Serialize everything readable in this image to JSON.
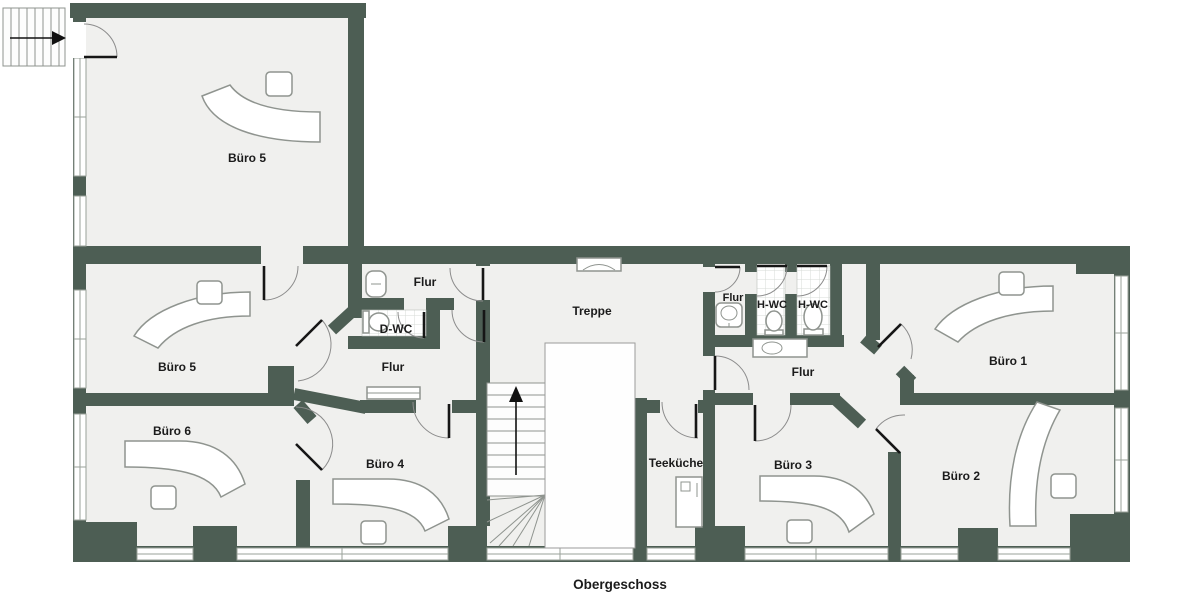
{
  "colors": {
    "bg": "#ffffff",
    "wall": "#4d5e54",
    "floor": "#f0f0ee",
    "void": "#fefefe",
    "label": "#1b1b1b",
    "furniture": "#8f948f",
    "door": "#161616",
    "window": "#9aa29a",
    "tile": "#d7dbd7"
  },
  "floor_label": "Obergeschoss",
  "rooms": [
    {
      "id": "buero5-upper",
      "label": "Büro 5"
    },
    {
      "id": "buero5-mid",
      "label": "Büro 5"
    },
    {
      "id": "buero6",
      "label": "Büro 6"
    },
    {
      "id": "buero4",
      "label": "Büro 4"
    },
    {
      "id": "flur-top",
      "label": "Flur"
    },
    {
      "id": "d-wc",
      "label": "D-WC"
    },
    {
      "id": "flur-central",
      "label": "Flur"
    },
    {
      "id": "treppe",
      "label": "Treppe"
    },
    {
      "id": "teekueche",
      "label": "Teeküche"
    },
    {
      "id": "flur-wc",
      "label": "Flur"
    },
    {
      "id": "h-wc-left",
      "label": "H-WC"
    },
    {
      "id": "h-wc-right",
      "label": "H-WC"
    },
    {
      "id": "flur-right",
      "label": "Flur"
    },
    {
      "id": "buero1",
      "label": "Büro 1"
    },
    {
      "id": "buero3",
      "label": "Büro 3"
    },
    {
      "id": "buero2",
      "label": "Büro 2"
    }
  ]
}
